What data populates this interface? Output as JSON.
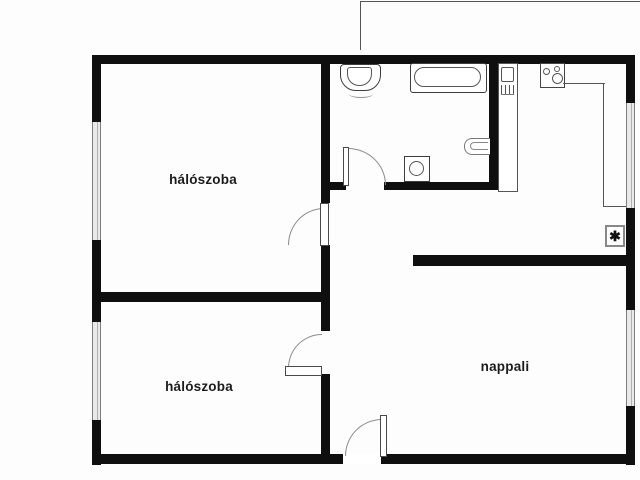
{
  "plan": {
    "type": "apartment-floor-plan",
    "rooms": [
      {
        "id": "bedroom-1",
        "label": "hálószoba"
      },
      {
        "id": "bedroom-2",
        "label": "hálószoba"
      },
      {
        "id": "living-room",
        "label": "nappali"
      }
    ],
    "fixtures": [
      "washbasin",
      "bathtub",
      "toilet",
      "washing-machine",
      "kitchen-sink-cabinet",
      "stove",
      "kitchen-counter",
      "boiler-box"
    ],
    "symbols": {
      "boiler_asterisk": "✱"
    },
    "colors": {
      "wall": "#0f0f0f",
      "fixture_line": "#3d3d3d",
      "door_arc": "#8b8b8b",
      "window_fill": "#e9e9e9",
      "window_edge": "#7e7e7e",
      "background": "#fdfdfd",
      "label_text": "#1c1c1c"
    }
  }
}
